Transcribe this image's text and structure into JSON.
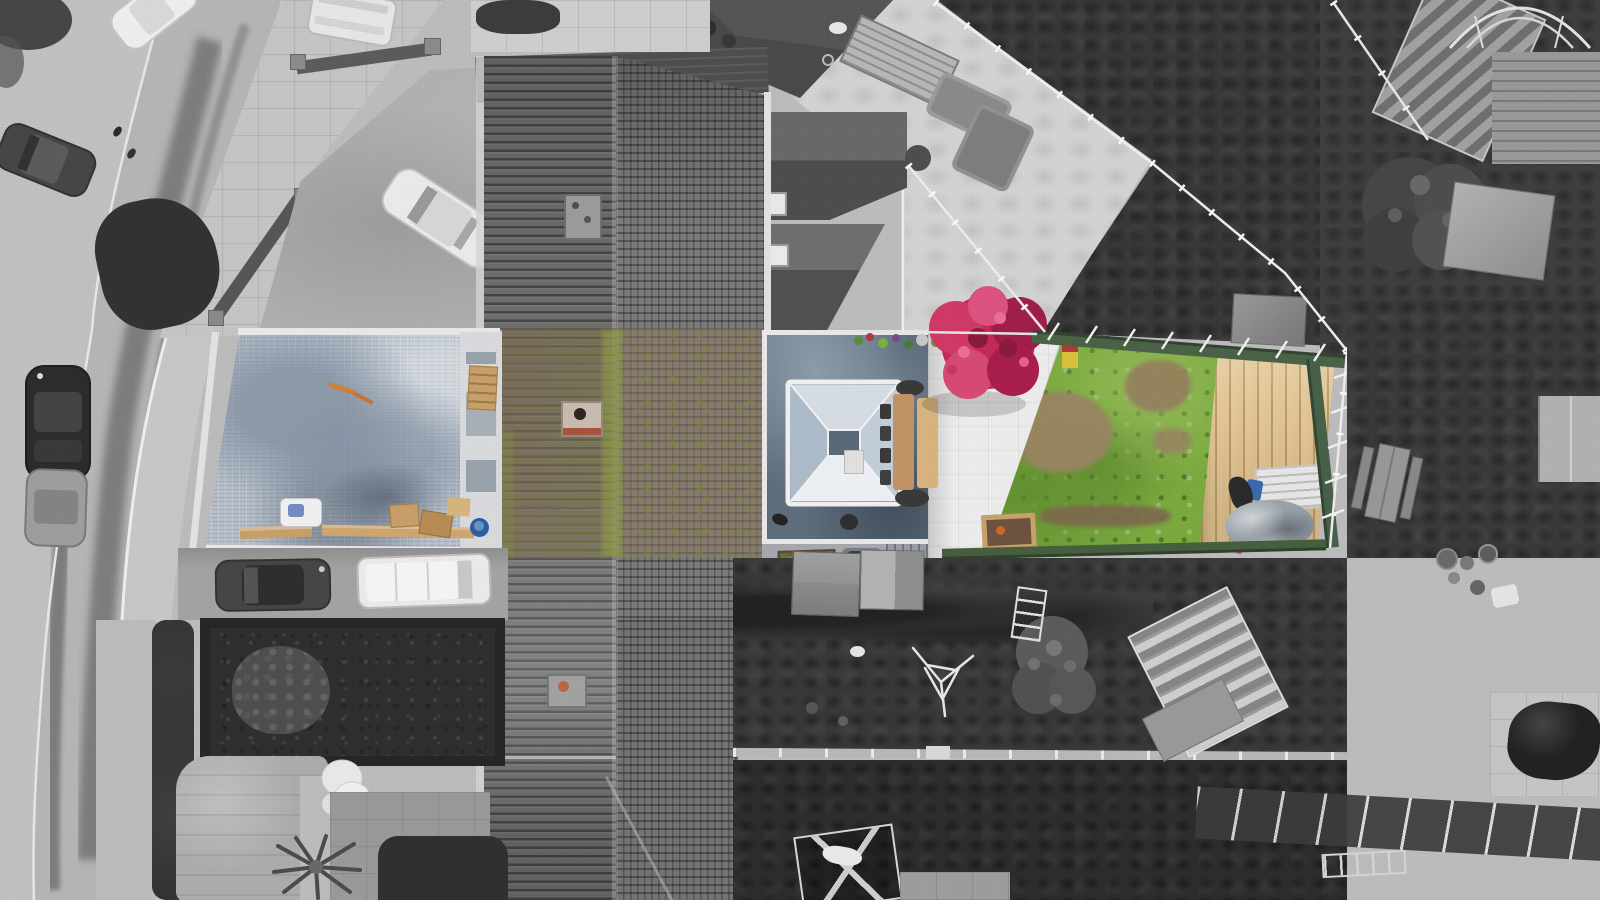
{
  "colors": {
    "grayRoad": "#b6b6b6",
    "graySidewalk": "#c8c8c8",
    "grayPavement": "#c6c6c6",
    "grayDriveway": "#b0b0b0",
    "grayPatio": "#d4d4d4",
    "whitePaving": "#ededed",
    "darkLawn": "#383838",
    "darkerLawn": "#2d2d2d",
    "hedge": "#2f2f2f",
    "roofDark": "#6e6e6e",
    "roofMid": "#7c7c7c",
    "roofBandTop": "#4f4f4f",
    "mossGreen": "#7a8a3e",
    "roofMossWarm": "#8d7560",
    "ridgeMoss": "#96a84a",
    "courtBlue": "#b7c0cc",
    "courtBlueDark": "#8795a6",
    "extRoof": "#5f6e7d",
    "extRoofLight": "#9db0c0",
    "lanternGlass": "#cfdae3",
    "grass": "#7cab3f",
    "grassDark": "#5d8a2e",
    "patchBrown": "#9b8563",
    "treeMagenta": "#c62a57",
    "treeMagentaDark": "#a01f4a",
    "treeMagentaLight": "#de5380",
    "deckWood": "#e3c795",
    "deckWoodDark": "#cfae75",
    "fenceGreen": "#4a6347",
    "tableWood": "#c49468",
    "tableWoodLight": "#d9b47f",
    "tarpGray": "#9aa3ab",
    "barrelBlue": "#2e5fa3",
    "timberTan": "#c8a06a",
    "railWhite": "#f0f0f0"
  }
}
